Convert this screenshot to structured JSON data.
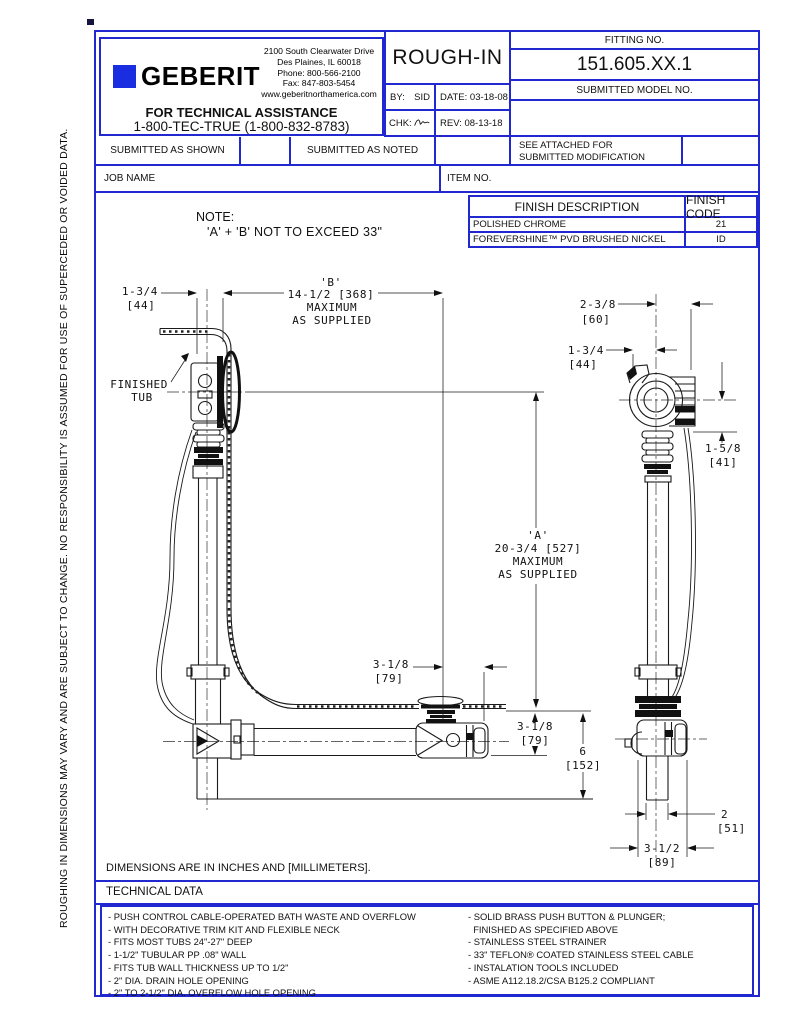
{
  "page": {
    "side_note": "ROUGHING IN DIMENSIONS MAY VARY AND ARE SUBJECT TO CHANGE.  NO RESPONSIBILITY  IS ASSUMED FOR USE OF SUPERCEDED OR VOIDED DATA.",
    "colors": {
      "border_blue": "#2128cf",
      "logo_blue": "#1b2de0",
      "ink": "#111111"
    }
  },
  "header": {
    "brand": "GEBERIT",
    "address_line1": "2100 South Clearwater Drive",
    "address_line2": "Des Plaines, IL 60018",
    "address_line3": "Phone: 800-566-2100",
    "address_line4": "Fax: 847-803-5454",
    "address_line5": "www.geberitnorthamerica.com",
    "assistance_title": "FOR TECHNICAL ASSISTANCE",
    "assistance_phone": "1-800-TEC-TRUE (1-800-832-8783)",
    "doc_title": "ROUGH-IN",
    "by_label": "BY:",
    "by_value": "SID",
    "date_label": "DATE: 03-18-08",
    "chk_label": "CHK:",
    "rev_label": "REV:  08-13-18",
    "fitting_label": "FITTING NO.",
    "fitting_value": "151.605.XX.1",
    "model_label": "SUBMITTED MODEL NO.",
    "see_attached_line1": "SEE ATTACHED FOR",
    "see_attached_line2": "SUBMITTED MODIFICATION"
  },
  "submittal": {
    "as_shown": "SUBMITTED AS SHOWN",
    "as_noted": "SUBMITTED AS NOTED",
    "job_name_label": "JOB NAME",
    "item_no_label": "ITEM NO."
  },
  "note": {
    "line1": "NOTE:",
    "line2": "'A' + 'B' NOT TO EXCEED 33\""
  },
  "finish_table": {
    "header_description": "FINISH DESCRIPTION",
    "header_code": "FINISH CODE",
    "rows": [
      {
        "description": "POLISHED CHROME",
        "code": "21"
      },
      {
        "description": "FOREVERSHINE™ PVD BRUSHED NICKEL",
        "code": "ID"
      }
    ]
  },
  "drawing": {
    "finished_tub_line1": "FINISHED",
    "finished_tub_line2": "TUB",
    "dim_b_name": "'B'",
    "dim_b_value": "14-1/2 [368]",
    "dim_b_max": "MAXIMUM",
    "dim_b_supplied": "AS SUPPLIED",
    "dim_left_in": "1-3/4",
    "dim_left_mm": "[44]",
    "dim_a_name": "'A'",
    "dim_a_value": "20-3/4 [527]",
    "dim_a_max": "MAXIMUM",
    "dim_a_supplied": "AS SUPPLIED",
    "dim_318a_in": "3-1/8",
    "dim_318a_mm": "[79]",
    "dim_318b_in": "3-1/8",
    "dim_318b_mm": "[79]",
    "dim_6_in": "6",
    "dim_6_mm": "[152]",
    "dim_238_in": "2-3/8",
    "dim_238_mm": "[60]",
    "dim_134_in": "1-3/4",
    "dim_134_mm": "[44]",
    "dim_158_in": "1-5/8",
    "dim_158_mm": "[41]",
    "dim_2_in": "2",
    "dim_2_mm": "[51]",
    "dim_312_in": "3-1/2",
    "dim_312_mm": "[89]"
  },
  "footer": {
    "units_note": "DIMENSIONS ARE IN INCHES AND [MILLIMETERS].",
    "tech_title": "TECHNICAL DATA",
    "tech_left": [
      "- PUSH CONTROL CABLE-OPERATED BATH WASTE AND OVERFLOW",
      "- WITH DECORATIVE TRIM KIT AND FLEXIBLE NECK",
      "- FITS MOST TUBS 24\"-27\" DEEP",
      "- 1-1/2\" TUBULAR PP .08\" WALL",
      "- FITS TUB WALL THICKNESS UP TO 1/2\"",
      "- 2\" DIA. DRAIN HOLE OPENING",
      "- 2\" TO 2-1/2\" DIA. OVERFLOW HOLE OPENING"
    ],
    "tech_right": [
      "- SOLID BRASS PUSH BUTTON & PLUNGER;",
      "  FINISHED AS SPECIFIED ABOVE",
      "- STAINLESS STEEL STRAINER",
      "- 33\" TEFLON® COATED STAINLESS STEEL CABLE",
      "- INSTALATION TOOLS INCLUDED",
      "- ASME A112.18.2/CSA B125.2 COMPLIANT"
    ]
  }
}
